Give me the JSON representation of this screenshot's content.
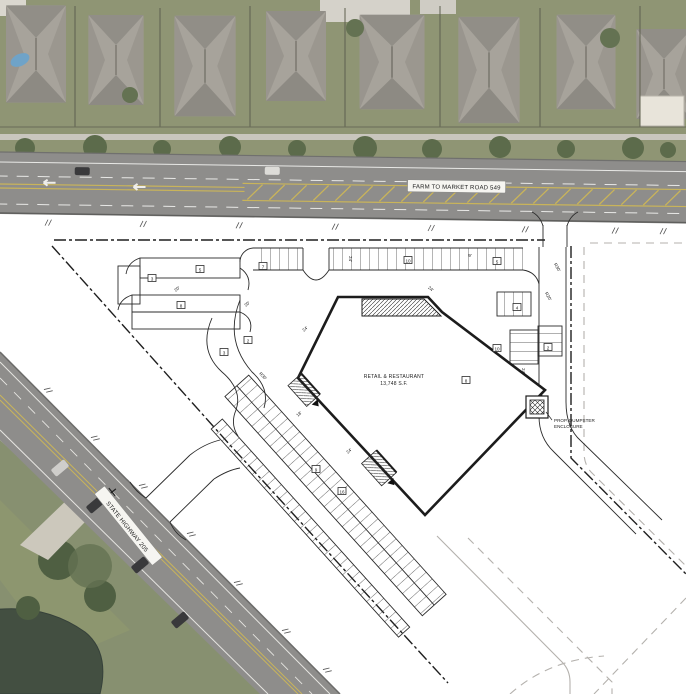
{
  "roads": {
    "north": {
      "label": "FARM TO MARKET ROAD 549"
    },
    "west": {
      "label": "STATE HIGHWAY 205"
    }
  },
  "site": {
    "building": {
      "line1": "RETAIL & RESTAURANT",
      "line2": "13,748 S.F."
    },
    "dumpster": {
      "line1": "PROP. DUMPSTER",
      "line2": "ENCLOSURE"
    },
    "parking_counts": [
      {
        "label": "7",
        "x": 263,
        "y": 267
      },
      {
        "label": "10",
        "x": 408,
        "y": 261
      },
      {
        "label": "5",
        "x": 497,
        "y": 262
      },
      {
        "label": "3",
        "x": 152,
        "y": 279
      },
      {
        "label": "5",
        "x": 200,
        "y": 270
      },
      {
        "label": "8",
        "x": 181,
        "y": 306
      },
      {
        "label": "3",
        "x": 224,
        "y": 353
      },
      {
        "label": "2",
        "x": 248,
        "y": 341
      },
      {
        "label": "4",
        "x": 517,
        "y": 308
      },
      {
        "label": "2",
        "x": 548,
        "y": 348
      },
      {
        "label": "10",
        "x": 497,
        "y": 349
      },
      {
        "label": "8",
        "x": 466,
        "y": 381
      },
      {
        "label": "9",
        "x": 316,
        "y": 470
      },
      {
        "label": "16",
        "x": 342,
        "y": 492
      }
    ],
    "dimensions": [
      {
        "label": "24'",
        "x": 349,
        "y": 259,
        "r": 90
      },
      {
        "label": "9'",
        "x": 470,
        "y": 257,
        "r": 0
      },
      {
        "label": "24'",
        "x": 306,
        "y": 330,
        "r": -42
      },
      {
        "label": "20'",
        "x": 248,
        "y": 305,
        "r": -42
      },
      {
        "label": "R30'",
        "x": 556,
        "y": 268,
        "r": 60
      },
      {
        "label": "R20'",
        "x": 547,
        "y": 297,
        "r": 60
      },
      {
        "label": "24'",
        "x": 522,
        "y": 371,
        "r": 90
      },
      {
        "label": "24'",
        "x": 350,
        "y": 452,
        "r": -42
      },
      {
        "label": "R30'",
        "x": 262,
        "y": 377,
        "r": 45
      },
      {
        "label": "20'",
        "x": 178,
        "y": 290,
        "r": -40
      },
      {
        "label": "24'",
        "x": 430,
        "y": 290,
        "r": 40
      },
      {
        "label": "18'",
        "x": 300,
        "y": 415,
        "r": -42
      }
    ]
  },
  "colors": {
    "plan_bg": "#ffffff",
    "plan_line": "#2b2b2b",
    "boundary_line": "#1f1f1f",
    "future_line": "#b4b1ad",
    "asphalt": "#8e8d8b",
    "lane_yellow": "#c9b45a",
    "lawn": "#8f9574",
    "tree": "#5c6b4b",
    "pond": "#434f41",
    "roof": "#a7a39b",
    "pool": "#6fa3c8"
  }
}
